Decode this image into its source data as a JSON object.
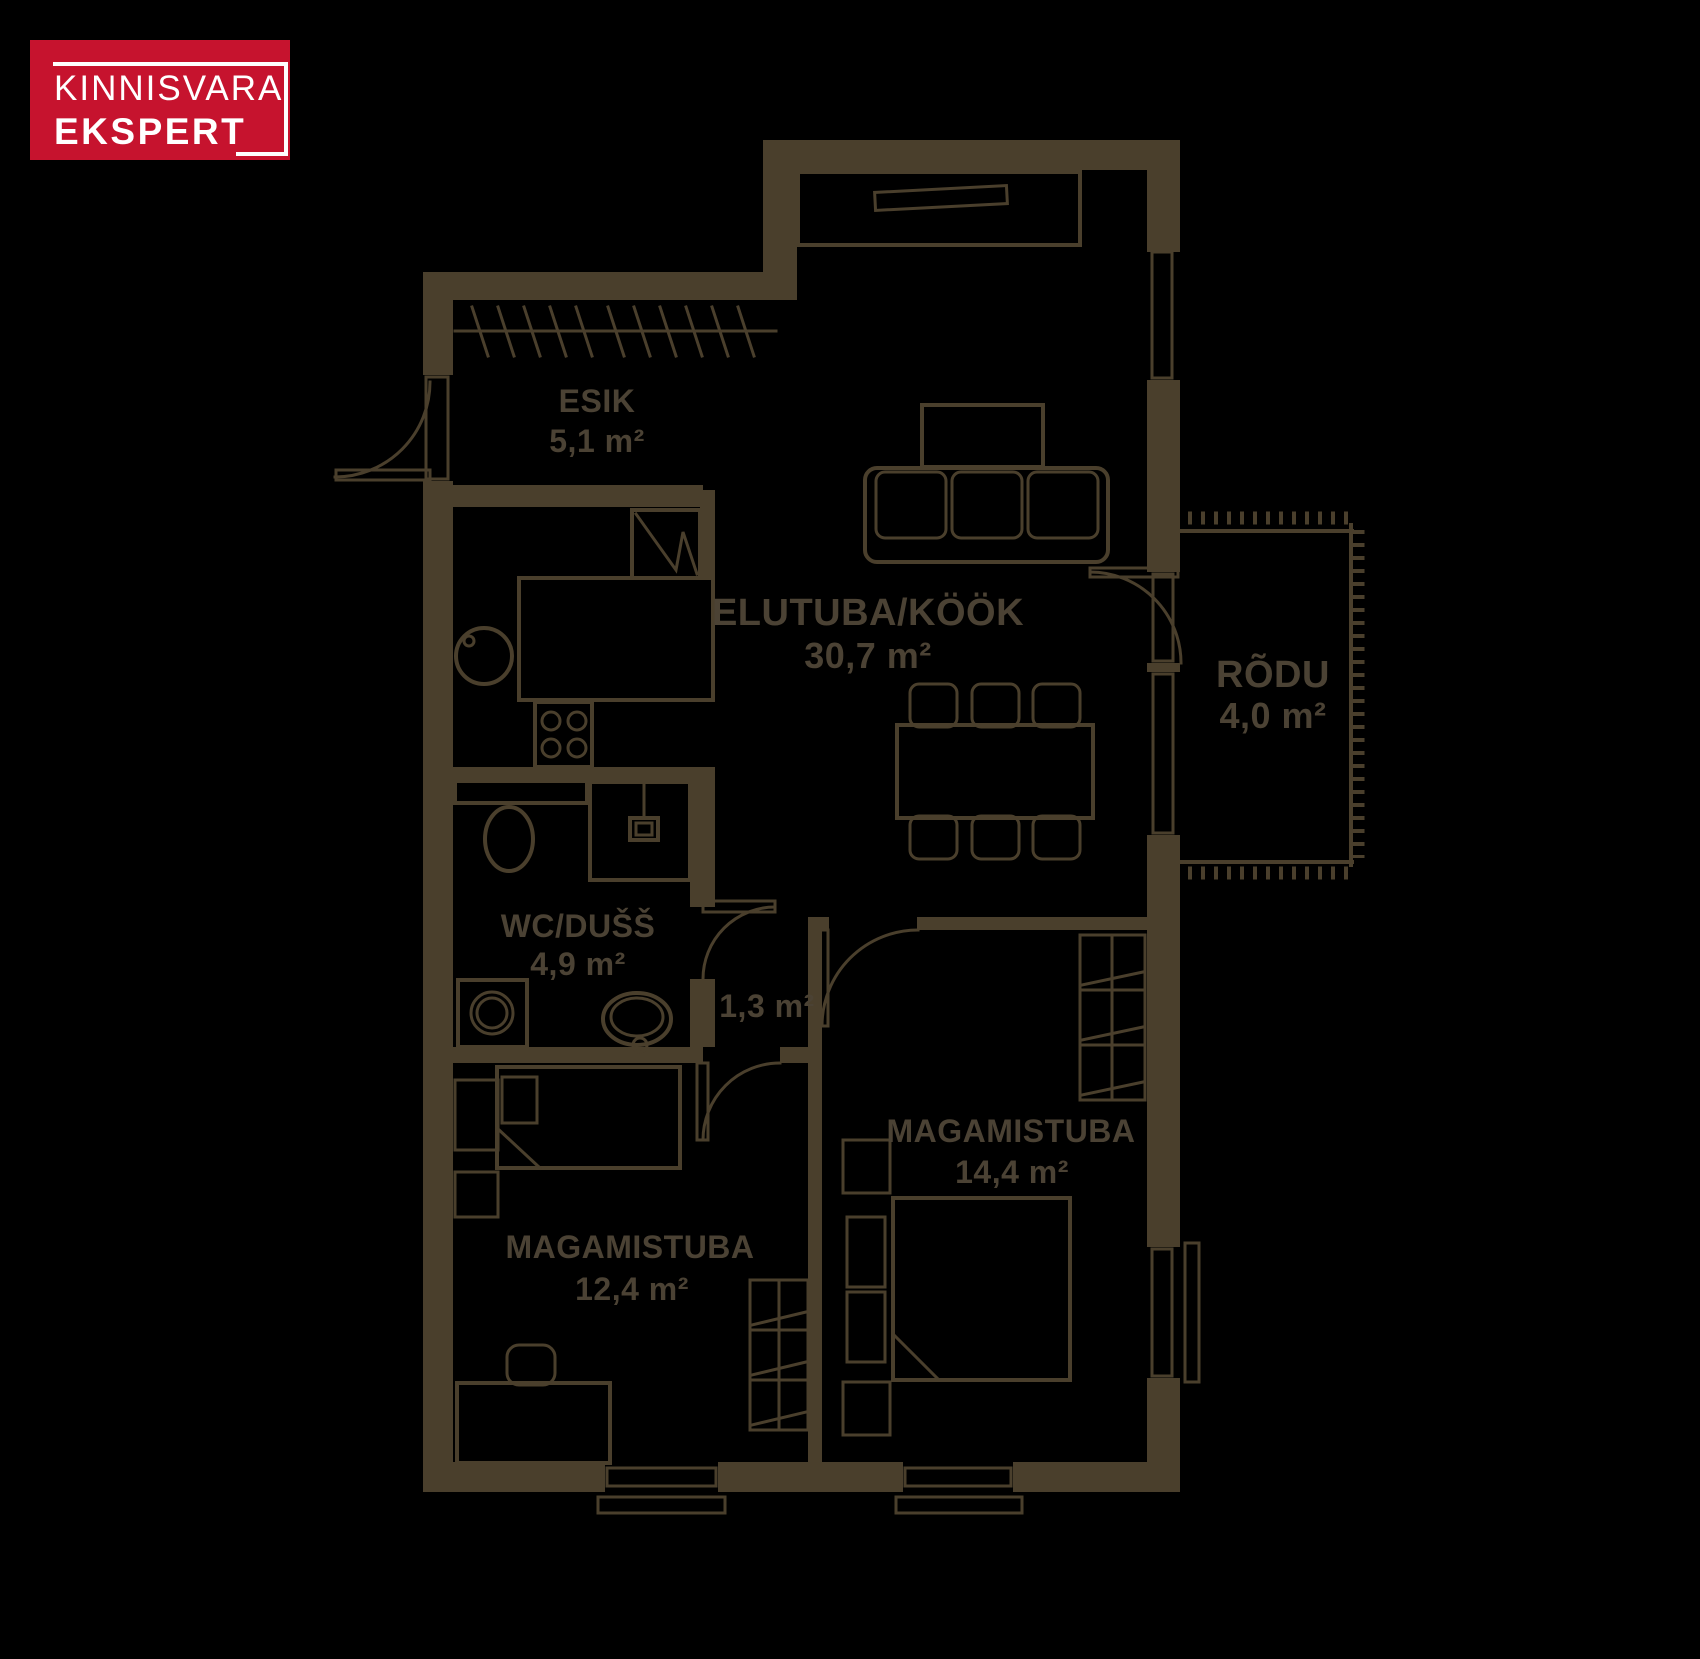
{
  "logo": {
    "line1": "KINNISVARA",
    "line2": "EKSPERT",
    "bg_color": "#C6132E",
    "text_color": "#FFFFFF"
  },
  "floorplan": {
    "background_color": "#000000",
    "wall_color": "#4A3F2C",
    "text_color": "#4B4234",
    "rooms": [
      {
        "id": "esik",
        "name": "ESIK",
        "area": "5,1 m²"
      },
      {
        "id": "elutuba-kook",
        "name": "ELUTUBA/KÖÖK",
        "area": "30,7 m²"
      },
      {
        "id": "rodu",
        "name": "RÕDU",
        "area": "4,0 m²"
      },
      {
        "id": "wc-duss",
        "name": "WC/DUŠŠ",
        "area": "4,9 m²"
      },
      {
        "id": "koridor",
        "name": "",
        "area": "1,3 m²"
      },
      {
        "id": "magamistuba-1",
        "name": "MAGAMISTUBA",
        "area": "14,4 m²"
      },
      {
        "id": "magamistuba-2",
        "name": "MAGAMISTUBA",
        "area": "12,4 m²"
      }
    ]
  }
}
